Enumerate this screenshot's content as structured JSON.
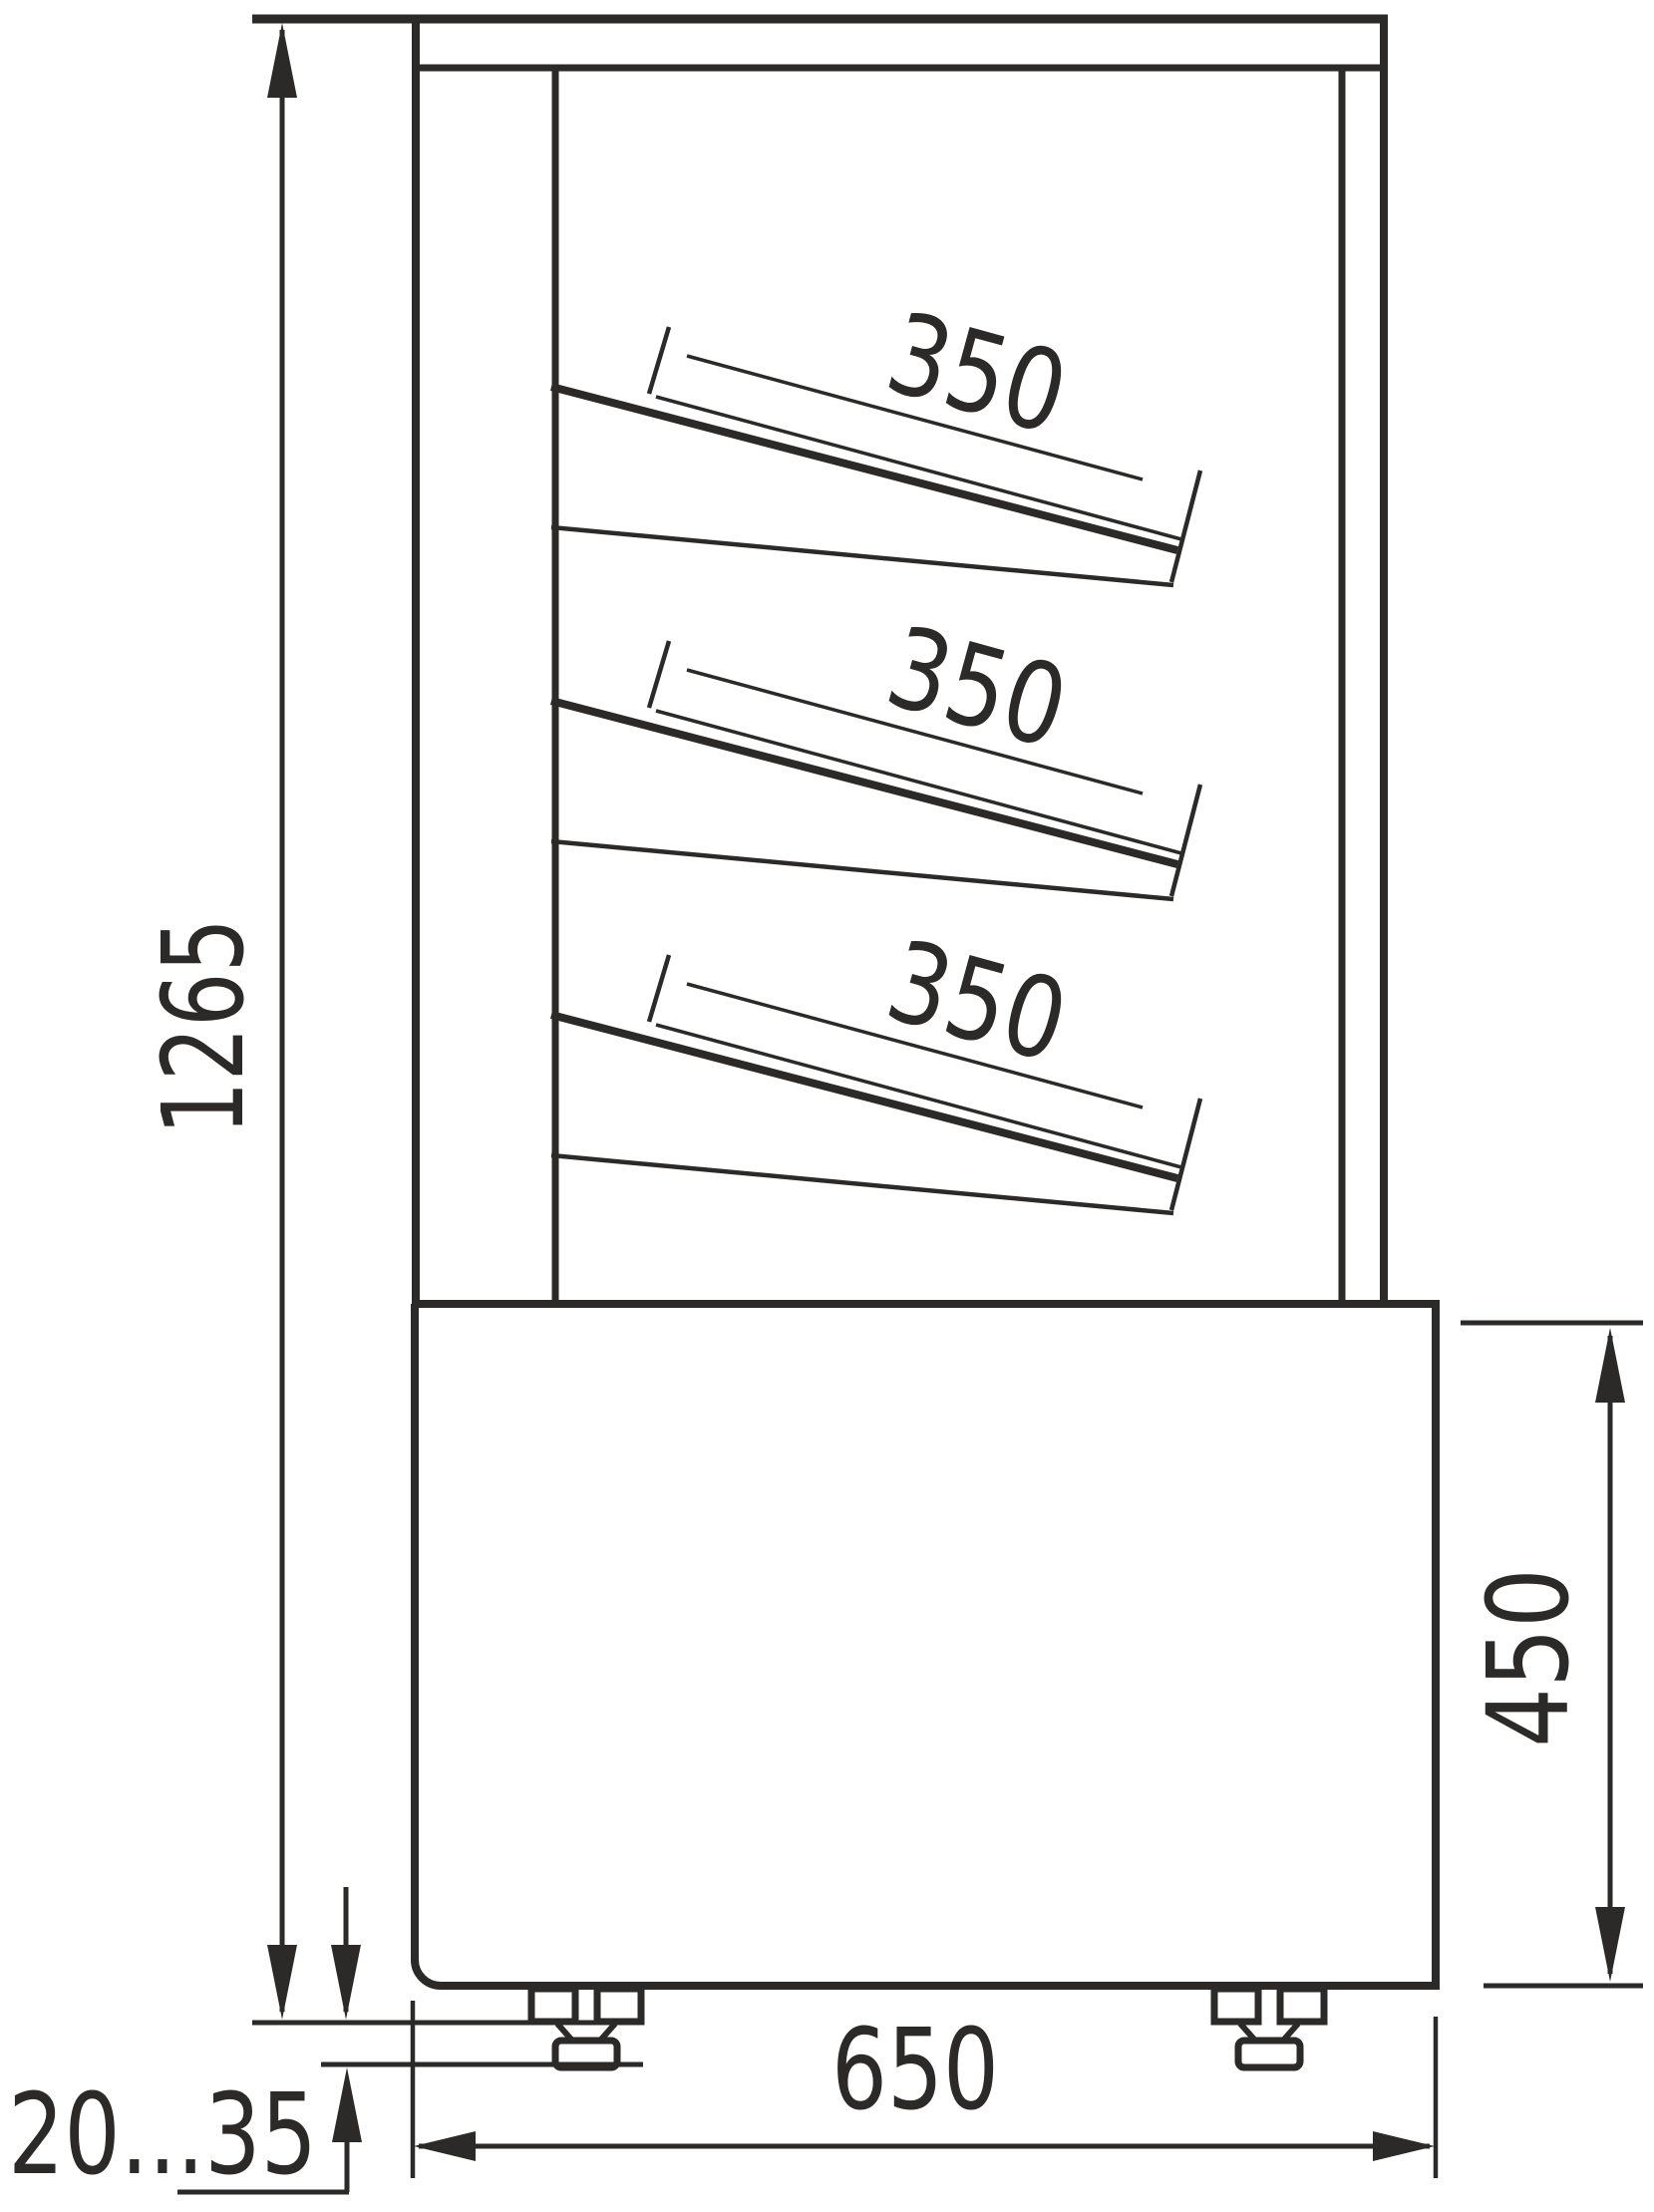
{
  "drawing": {
    "kind": "technical dimension drawing",
    "subject": "refrigerated confectionery display case, side elevation",
    "units": "mm",
    "line_color": "#2b2a29",
    "background_color": "#ffffff",
    "dims": {
      "overall_height": {
        "value": "1265"
      },
      "base_height": {
        "value": "450"
      },
      "base_depth": {
        "value": "650"
      },
      "foot_height_range": {
        "value": "20...35"
      }
    },
    "shelves": [
      {
        "depth_label": "350"
      },
      {
        "depth_label": "350"
      },
      {
        "depth_label": "350"
      }
    ]
  }
}
